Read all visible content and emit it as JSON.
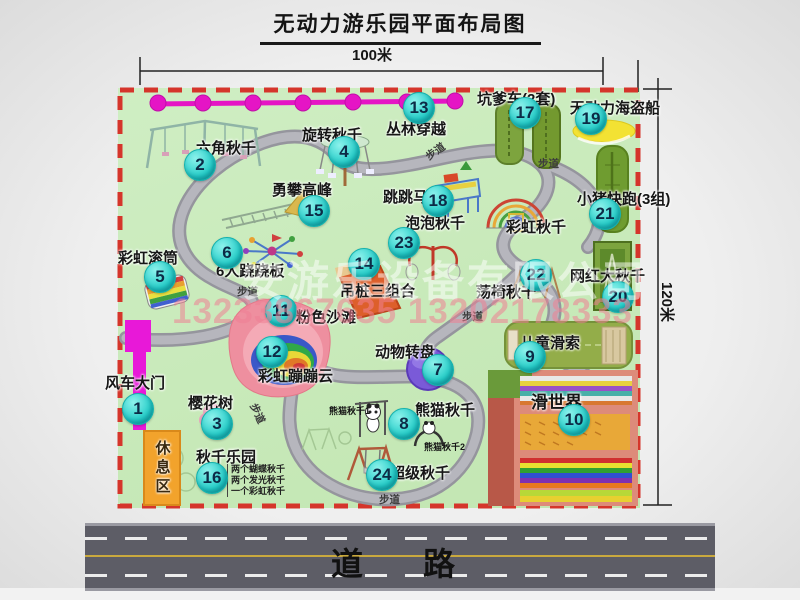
{
  "title": "无动力游乐园平面布局图",
  "dimensions": {
    "width": "100米",
    "height": "120米"
  },
  "road_label": "道　路",
  "walkway_label": "步道",
  "rest_area_label": "休息区",
  "watermark": {
    "company": "安游乐设备有限公司",
    "phone": "13233867635 13202178333"
  },
  "attractions": [
    {
      "num": 1,
      "name": "风车大门"
    },
    {
      "num": 2,
      "name": "六角秋千"
    },
    {
      "num": 3,
      "name": "樱花树"
    },
    {
      "num": 4,
      "name": "旋转秋千"
    },
    {
      "num": 5,
      "name": "彩虹滚筒"
    },
    {
      "num": 6,
      "name": "6人跷跷板"
    },
    {
      "num": 7,
      "name": "动物转盘"
    },
    {
      "num": 8,
      "name": "熊猫秋千"
    },
    {
      "num": 9,
      "name": "儿童滑索"
    },
    {
      "num": 10,
      "name": "滑世界"
    },
    {
      "num": 11,
      "name": "粉色沙滩"
    },
    {
      "num": 12,
      "name": "彩虹蹦蹦云"
    },
    {
      "num": 13,
      "name": "丛林穿越"
    },
    {
      "num": 14,
      "name": "吊桩三组合"
    },
    {
      "num": 15,
      "name": "勇攀高峰"
    },
    {
      "num": 16,
      "name": "秋千乐园"
    },
    {
      "num": 17,
      "name": "坑爹车(2套)"
    },
    {
      "num": 18,
      "name": "跳跳马"
    },
    {
      "num": 19,
      "name": "无动力海盗船"
    },
    {
      "num": 20,
      "name": "网红大秋千"
    },
    {
      "num": 21,
      "name": "小猪快跑(3组)"
    },
    {
      "num": 22,
      "name": "荡椅秋千"
    },
    {
      "num": 23,
      "name": "泡泡秋千"
    },
    {
      "num": 24,
      "name": "超级秋千"
    }
  ],
  "unnumbered": {
    "rainbow_swing": "彩虹秋千",
    "panda_swing_1": "熊猫秋千1",
    "panda_swing_2": "熊猫秋千2"
  },
  "swing_park_notes": [
    "两个蝴蝶秋千",
    "两个发光秋千",
    "一个彩虹秋千"
  ]
}
